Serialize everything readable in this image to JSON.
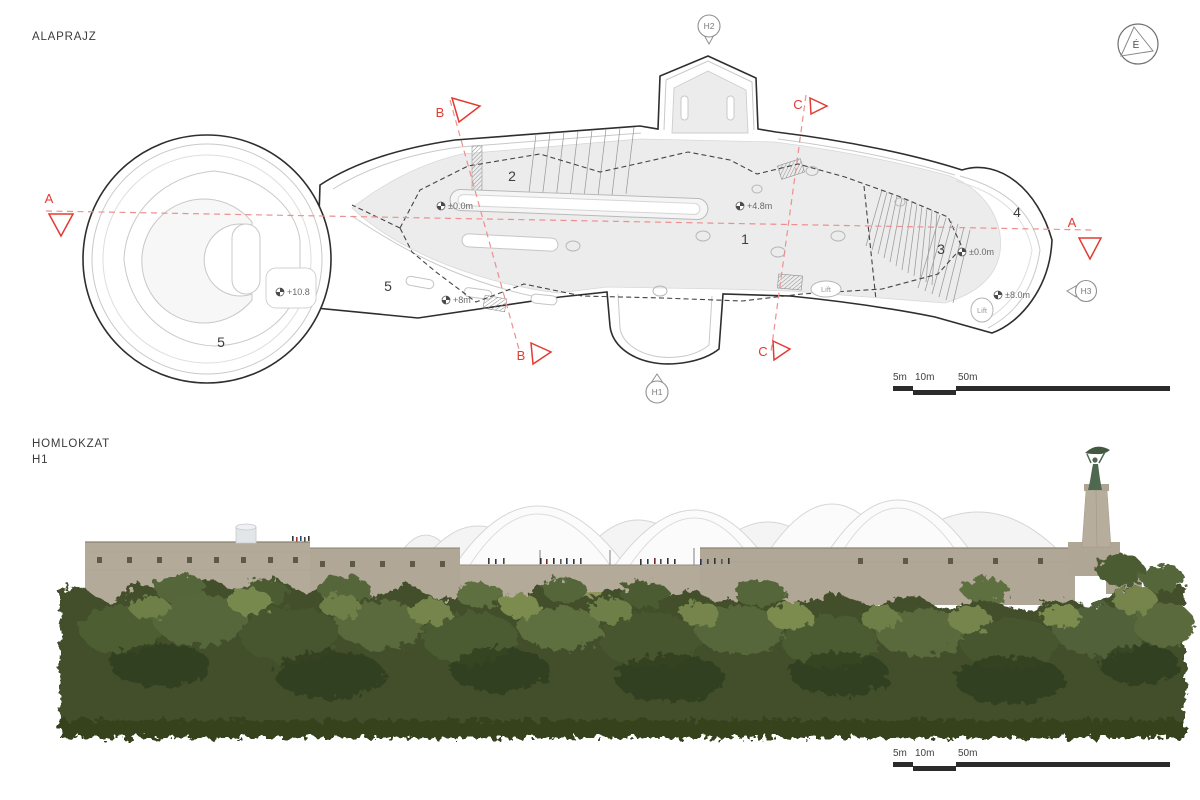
{
  "plan": {
    "title": "ALAPRAJZ",
    "north_label": "É",
    "sections": {
      "a": "A",
      "b": "B",
      "c": "C"
    },
    "markers": {
      "h1": "H1",
      "h2": "H2",
      "h3": "H3"
    },
    "zones": {
      "z1": "1",
      "z2": "2",
      "z3": "3",
      "z4": "4",
      "z5_bastion": "5",
      "z5_terrace": "5"
    },
    "levels": {
      "entry": "±0.0m",
      "courtyard": "+4.8m",
      "west_bastion": "+10.8",
      "terrace": "+8m",
      "east_court": "±0.0m",
      "east_terrace": "±8.0m"
    },
    "lift_label": "Lift",
    "scale_labels": [
      "5m",
      "10m",
      "50m"
    ]
  },
  "elevation": {
    "title": "HOMLOKZAT",
    "view_marker": "H1",
    "scale_labels": [
      "5m",
      "10m",
      "50m"
    ]
  },
  "colors": {
    "section_red": "#e23b32",
    "section_line_pink": "#ee8f8f",
    "plan_wall_line": "#2e2e2e",
    "plan_fill_gray": "#ececec",
    "stone": "#b3aa99",
    "canopy_white": "#fafafa",
    "foliage_green": "#42502c"
  }
}
